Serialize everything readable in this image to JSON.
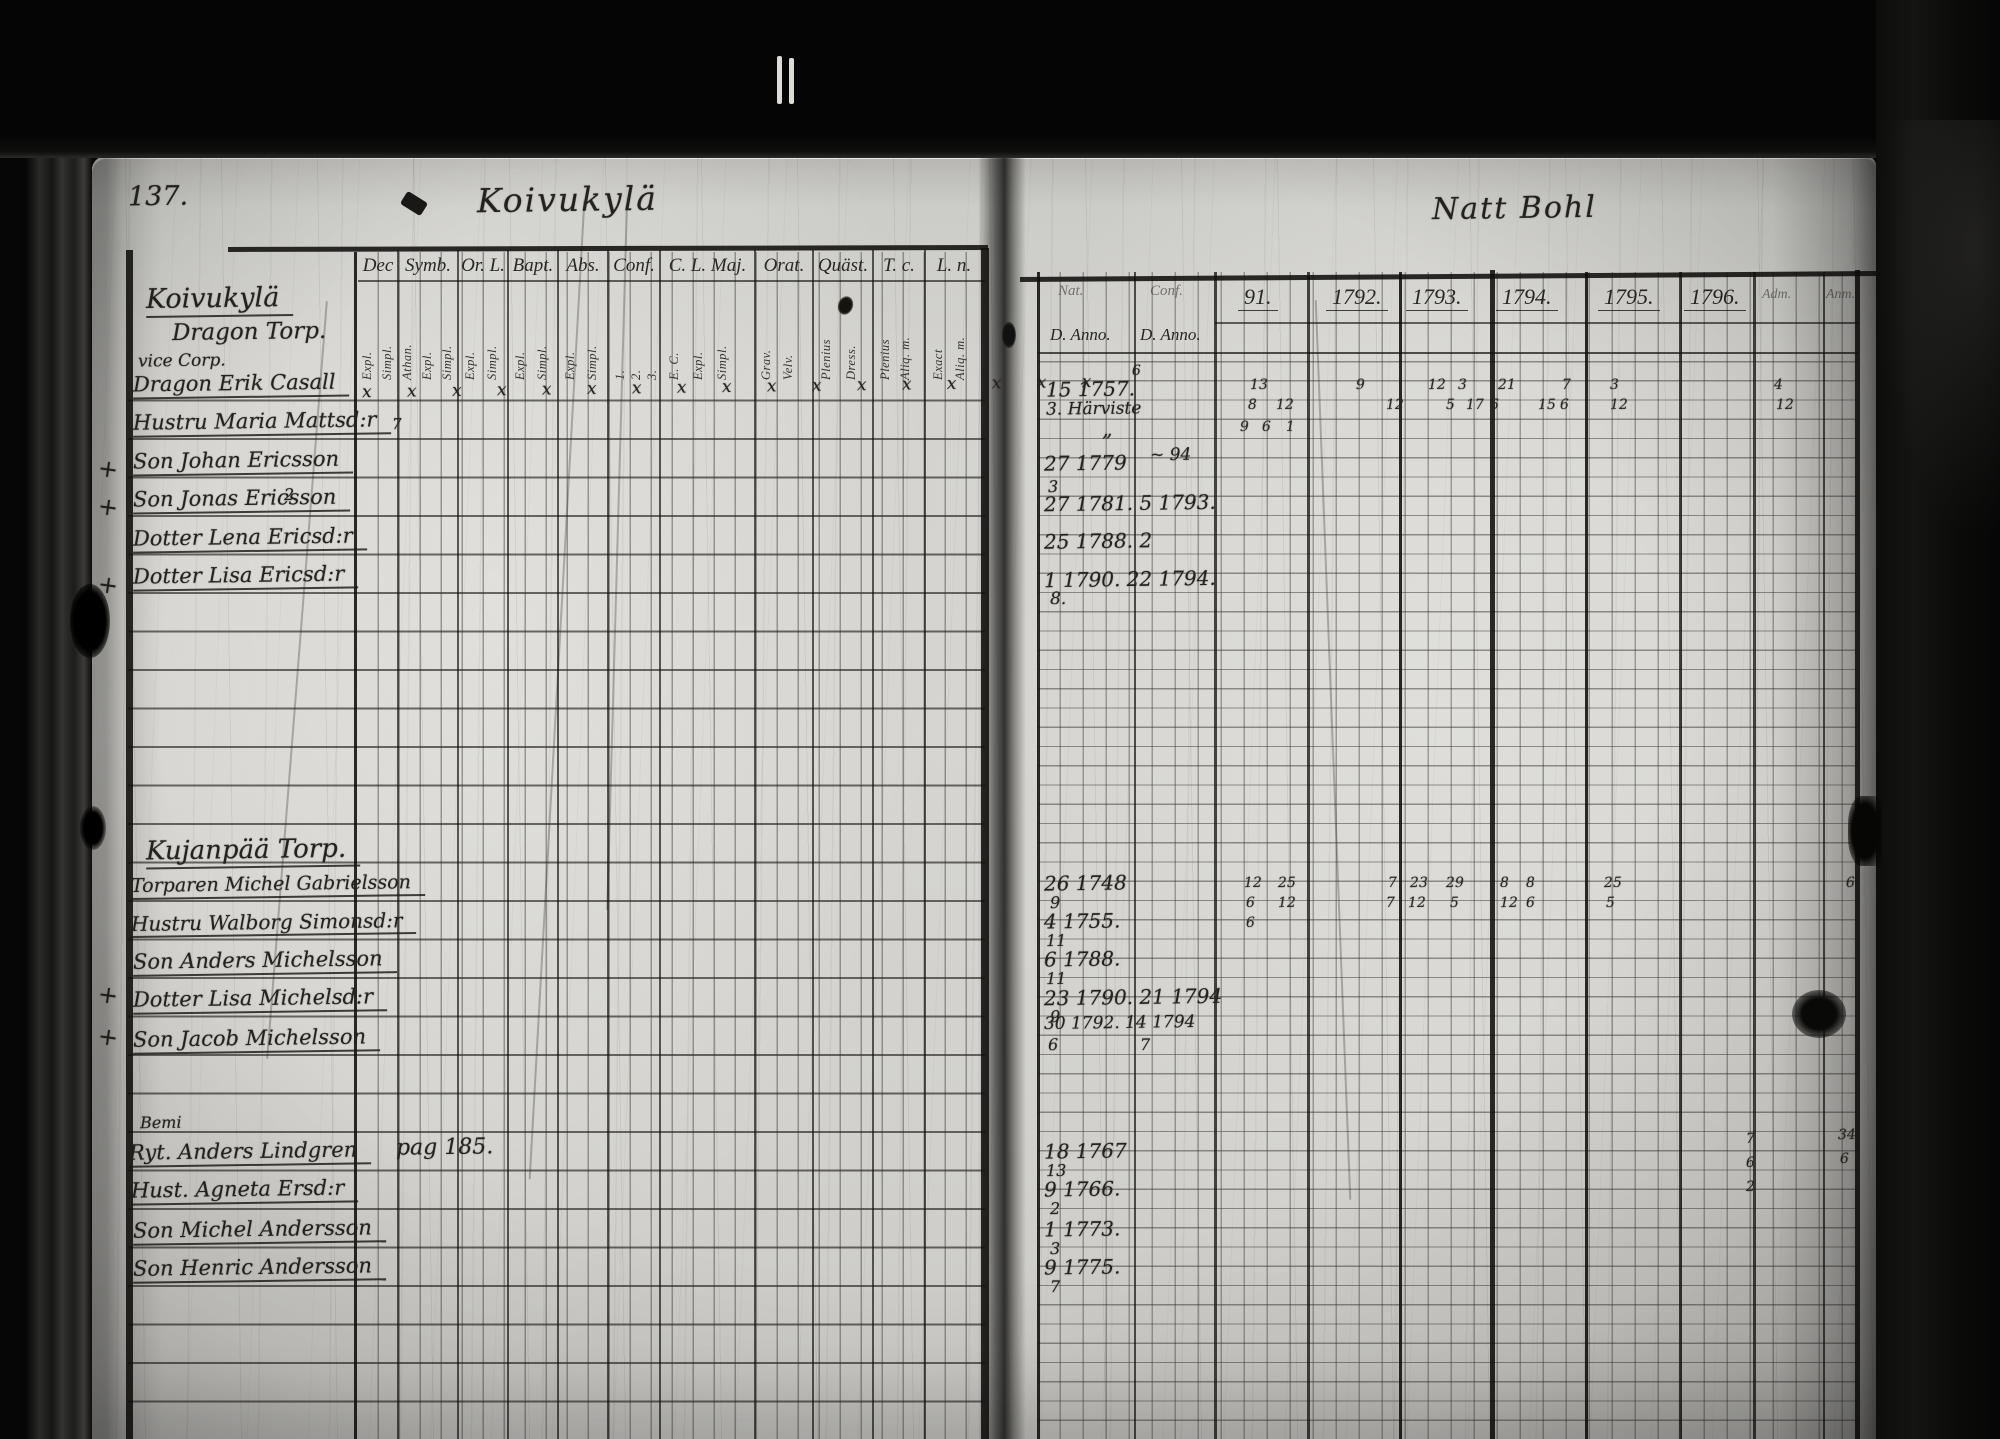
{
  "meta": {
    "kind": "scanned archival parish register spread",
    "paper_color": "#d4d3cf",
    "ink_color": "#24221f"
  },
  "left_page": {
    "page_number": "137.",
    "title": "Koivukylä",
    "x_marks_row": "x x x x x x x x x x x x x x x x x",
    "columns": [
      {
        "label": "Dec",
        "x": 358,
        "w": 40,
        "subs": [
          {
            "t": "Expl.",
            "x": 361
          },
          {
            "t": "Simpl.",
            "x": 381
          }
        ]
      },
      {
        "label": "Symb.",
        "x": 398,
        "w": 60,
        "subs": [
          {
            "t": "Athan.",
            "x": 401
          },
          {
            "t": "Expl.",
            "x": 421
          },
          {
            "t": "Simpl.",
            "x": 441
          }
        ]
      },
      {
        "label": "Or. L.",
        "x": 458,
        "w": 50,
        "subs": [
          {
            "t": "Expl.",
            "x": 464
          },
          {
            "t": "Simpl.",
            "x": 486
          }
        ]
      },
      {
        "label": "Bapt.",
        "x": 508,
        "w": 50,
        "subs": [
          {
            "t": "Expl.",
            "x": 514
          },
          {
            "t": "Simpl.",
            "x": 536
          }
        ]
      },
      {
        "label": "Abs.",
        "x": 558,
        "w": 50,
        "subs": [
          {
            "t": "Expl.",
            "x": 564
          },
          {
            "t": "Simpl.",
            "x": 586
          }
        ]
      },
      {
        "label": "Conf.",
        "x": 608,
        "w": 52,
        "subs": [
          {
            "t": "1.",
            "x": 614
          },
          {
            "t": "2.",
            "x": 630
          },
          {
            "t": "3.",
            "x": 646
          }
        ]
      },
      {
        "label": "C. L. Maj.",
        "x": 660,
        "w": 95,
        "subs": [
          {
            "t": "E. C.",
            "x": 668
          },
          {
            "t": "Expl.",
            "x": 692
          },
          {
            "t": "Simpl.",
            "x": 716
          }
        ]
      },
      {
        "label": "Orat.",
        "x": 755,
        "w": 58,
        "subs": [
          {
            "t": "Grav.",
            "x": 760
          },
          {
            "t": "Velv.",
            "x": 782
          }
        ]
      },
      {
        "label": "Quäst.",
        "x": 813,
        "w": 60,
        "subs": [
          {
            "t": "Plenius",
            "x": 820
          },
          {
            "t": "Dress.",
            "x": 845
          }
        ]
      },
      {
        "label": "T. c.",
        "x": 873,
        "w": 52,
        "subs": [
          {
            "t": "Plenius",
            "x": 879
          },
          {
            "t": "Aliq. m.",
            "x": 899
          }
        ]
      },
      {
        "label": "L. n.",
        "x": 925,
        "w": 58,
        "subs": [
          {
            "t": "Exact",
            "x": 932
          },
          {
            "t": "Aliq. m.",
            "x": 954
          }
        ]
      }
    ],
    "sections": [
      {
        "heading": {
          "t": "Koivukylä",
          "x": 146,
          "y": 284,
          "s": 27
        },
        "heading2": {
          "t": "Dragon Torp.",
          "x": 172,
          "y": 320,
          "s": 23
        },
        "sub": {
          "t": "vice Corp.",
          "x": 138,
          "y": 352,
          "s": 17
        },
        "rows": [
          {
            "t": "Dragon Erik Casall",
            "x": 133,
            "y": 372
          },
          {
            "t": "Hustru Maria Mattsd:r",
            "x": 133,
            "y": 410
          },
          {
            "t": "Son Johan Ericsson",
            "x": 133,
            "y": 449
          },
          {
            "t": "Son Jonas Ericsson",
            "x": 133,
            "y": 487
          },
          {
            "t": "Dotter Lena Ericsd:r",
            "x": 133,
            "y": 526
          },
          {
            "t": "Dotter Lisa Ericsd:r",
            "x": 133,
            "y": 564
          }
        ]
      },
      {
        "heading": {
          "t": "Kujanpää Torp.",
          "x": 146,
          "y": 836,
          "s": 26
        },
        "rows": [
          {
            "t": "Torparen Michel Gabrielsson",
            "x": 131,
            "y": 874,
            "s": 19
          },
          {
            "t": "Hustru Walborg Simonsd:r",
            "x": 131,
            "y": 911,
            "s": 20
          },
          {
            "t": "Son Anders Michelsson",
            "x": 133,
            "y": 949
          },
          {
            "t": "Dotter Lisa Michelsd:r",
            "x": 133,
            "y": 987
          },
          {
            "t": "Son Jacob Michelsson",
            "x": 133,
            "y": 1027
          }
        ]
      },
      {
        "sub": {
          "t": "Bemi",
          "x": 140,
          "y": 1114,
          "s": 16
        },
        "rows": [
          {
            "t": "Ryt. Anders Lindgren",
            "x": 129,
            "y": 1140
          },
          {
            "t": "Hust. Agneta Ersd:r",
            "x": 131,
            "y": 1178
          },
          {
            "t": "Son Michel Andersson",
            "x": 133,
            "y": 1218
          },
          {
            "t": "Son Henric Andersson",
            "x": 133,
            "y": 1256
          }
        ]
      }
    ],
    "notes": [
      {
        "t": "pag 185.",
        "x": 396,
        "y": 1136,
        "s": 22
      },
      {
        "t": "7",
        "x": 392,
        "y": 416,
        "s": 15
      },
      {
        "t": "2",
        "x": 284,
        "y": 486,
        "s": 16
      }
    ],
    "margin_crosses": [
      {
        "t": "+",
        "x": 98,
        "y": 456
      },
      {
        "t": "+",
        "x": 98,
        "y": 494
      },
      {
        "t": "+",
        "x": 98,
        "y": 572
      },
      {
        "t": "+",
        "x": 98,
        "y": 982
      },
      {
        "t": "+",
        "x": 98,
        "y": 1024
      }
    ]
  },
  "right_page": {
    "title": "Natt Bohl",
    "header": {
      "top1": "Nat.",
      "top2": "Conf.",
      "anno1": "D. Anno.",
      "anno2": "D. Anno.",
      "years": [
        {
          "t": "91.",
          "x": 1238
        },
        {
          "t": "1792.",
          "x": 1326
        },
        {
          "t": "1793.",
          "x": 1406
        },
        {
          "t": "1794.",
          "x": 1496
        },
        {
          "t": "1795.",
          "x": 1598
        },
        {
          "t": "1796.",
          "x": 1684
        }
      ],
      "right_labels": [
        {
          "t": "Adm.",
          "x": 1762
        },
        {
          "t": "Anm.",
          "x": 1826
        }
      ]
    },
    "entries": [
      {
        "t": "15 1757.",
        "x": 1046,
        "y": 378
      },
      {
        "t": "6",
        "x": 1132,
        "y": 364,
        "s": 14
      },
      {
        "t": "3. Härviste",
        "x": 1046,
        "y": 400,
        "s": 17
      },
      {
        "t": "„",
        "x": 1102,
        "y": 418,
        "s": 20
      },
      {
        "t": "27 1779",
        "x": 1044,
        "y": 452
      },
      {
        "t": "~ 94",
        "x": 1150,
        "y": 446,
        "s": 17
      },
      {
        "t": "3",
        "x": 1048,
        "y": 478,
        "s": 16
      },
      {
        "t": "27 1781. 5 1793.",
        "x": 1044,
        "y": 492
      },
      {
        "t": "25 1788. 2",
        "x": 1044,
        "y": 530
      },
      {
        "t": "1 1790. 22 1794.",
        "x": 1044,
        "y": 568
      },
      {
        "t": "8.",
        "x": 1050,
        "y": 590,
        "s": 17
      },
      {
        "t": "26 1748",
        "x": 1044,
        "y": 872
      },
      {
        "t": "9",
        "x": 1050,
        "y": 894,
        "s": 16
      },
      {
        "t": "4 1755.",
        "x": 1044,
        "y": 910
      },
      {
        "t": "11",
        "x": 1046,
        "y": 932,
        "s": 16
      },
      {
        "t": "6 1788.",
        "x": 1044,
        "y": 948
      },
      {
        "t": "11",
        "x": 1046,
        "y": 970,
        "s": 16
      },
      {
        "t": "23 1790. 21 1794",
        "x": 1044,
        "y": 986
      },
      {
        "t": "9",
        "x": 1050,
        "y": 1008,
        "s": 16
      },
      {
        "t": "30 1792. 14 1794",
        "x": 1044,
        "y": 1014,
        "s": 17
      },
      {
        "t": "6",
        "x": 1048,
        "y": 1036,
        "s": 16
      },
      {
        "t": "7",
        "x": 1140,
        "y": 1036,
        "s": 16
      },
      {
        "t": "18 1767",
        "x": 1044,
        "y": 1140
      },
      {
        "t": "13",
        "x": 1046,
        "y": 1162,
        "s": 16
      },
      {
        "t": "9 1766.",
        "x": 1044,
        "y": 1178
      },
      {
        "t": "2",
        "x": 1050,
        "y": 1200,
        "s": 16
      },
      {
        "t": "1 1773.",
        "x": 1044,
        "y": 1218
      },
      {
        "t": "3",
        "x": 1050,
        "y": 1240,
        "s": 16
      },
      {
        "t": "9 1775.",
        "x": 1044,
        "y": 1256
      },
      {
        "t": "7",
        "x": 1050,
        "y": 1278,
        "s": 16
      }
    ],
    "marks": [
      {
        "t": "13",
        "x": 1250,
        "y": 378
      },
      {
        "t": "9",
        "x": 1356,
        "y": 378
      },
      {
        "t": "12",
        "x": 1428,
        "y": 378
      },
      {
        "t": "3",
        "x": 1458,
        "y": 378
      },
      {
        "t": "21",
        "x": 1498,
        "y": 378
      },
      {
        "t": "7",
        "x": 1562,
        "y": 378
      },
      {
        "t": "3",
        "x": 1610,
        "y": 378
      },
      {
        "t": "4",
        "x": 1774,
        "y": 378
      },
      {
        "t": "8",
        "x": 1248,
        "y": 398
      },
      {
        "t": "12",
        "x": 1276,
        "y": 398
      },
      {
        "t": "12",
        "x": 1386,
        "y": 398
      },
      {
        "t": "5",
        "x": 1446,
        "y": 398
      },
      {
        "t": "17",
        "x": 1466,
        "y": 398
      },
      {
        "t": "6",
        "x": 1490,
        "y": 398
      },
      {
        "t": "15",
        "x": 1538,
        "y": 398
      },
      {
        "t": "6",
        "x": 1560,
        "y": 398
      },
      {
        "t": "12",
        "x": 1610,
        "y": 398
      },
      {
        "t": "12",
        "x": 1776,
        "y": 398
      },
      {
        "t": "9",
        "x": 1240,
        "y": 420
      },
      {
        "t": "6",
        "x": 1262,
        "y": 420
      },
      {
        "t": "1",
        "x": 1286,
        "y": 420
      },
      {
        "t": "12",
        "x": 1244,
        "y": 876
      },
      {
        "t": "25",
        "x": 1278,
        "y": 876
      },
      {
        "t": "7",
        "x": 1388,
        "y": 876
      },
      {
        "t": "23",
        "x": 1410,
        "y": 876
      },
      {
        "t": "29",
        "x": 1446,
        "y": 876
      },
      {
        "t": "8",
        "x": 1500,
        "y": 876
      },
      {
        "t": "8",
        "x": 1526,
        "y": 876
      },
      {
        "t": "25",
        "x": 1604,
        "y": 876
      },
      {
        "t": "6",
        "x": 1846,
        "y": 876
      },
      {
        "t": "6",
        "x": 1246,
        "y": 896
      },
      {
        "t": "12",
        "x": 1278,
        "y": 896
      },
      {
        "t": "7",
        "x": 1386,
        "y": 896
      },
      {
        "t": "12",
        "x": 1408,
        "y": 896
      },
      {
        "t": "5",
        "x": 1450,
        "y": 896
      },
      {
        "t": "12",
        "x": 1500,
        "y": 896
      },
      {
        "t": "6",
        "x": 1526,
        "y": 896
      },
      {
        "t": "5",
        "x": 1606,
        "y": 896
      },
      {
        "t": "6",
        "x": 1246,
        "y": 916
      },
      {
        "t": "7",
        "x": 1746,
        "y": 1132
      },
      {
        "t": "6",
        "x": 1746,
        "y": 1156
      },
      {
        "t": "2",
        "x": 1746,
        "y": 1180
      },
      {
        "t": "34",
        "x": 1838,
        "y": 1128
      },
      {
        "t": "6",
        "x": 1840,
        "y": 1152
      }
    ]
  }
}
